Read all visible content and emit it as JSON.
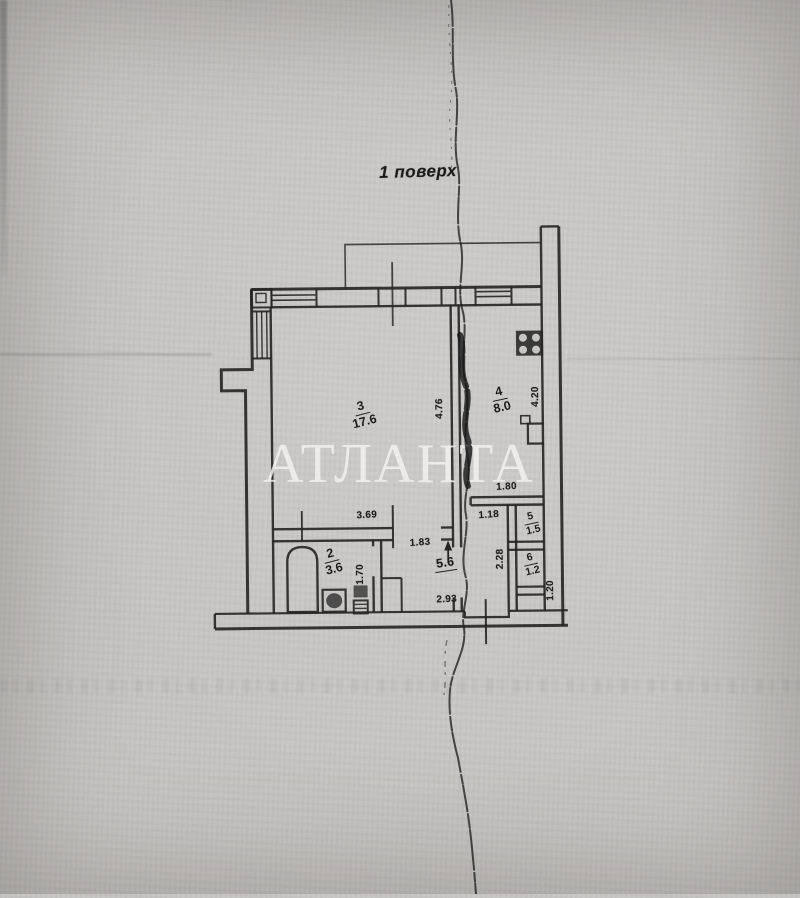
{
  "page": {
    "floor_title": "1 поверх",
    "watermark": "АТЛАНТА"
  },
  "rooms": [
    {
      "number": "3",
      "area": "17.6"
    },
    {
      "number": "4",
      "area": "8.0"
    },
    {
      "number": "2",
      "area": "3.6"
    },
    {
      "number": "5",
      "area": "1.5"
    },
    {
      "number": "6",
      "area": "1.2"
    }
  ],
  "hallway": {
    "area": "5.6"
  },
  "dims": {
    "living_width": "3.69",
    "living_height": "4.76",
    "kitchen_height": "4.20",
    "kitchen_pass": "1.80",
    "door_width": "1.83",
    "lobby_width": "1.18",
    "lobby_height": "2.28",
    "bath_depth": "1.70",
    "hall_width": "2.93",
    "shaft_height": "1.20"
  },
  "colors": {
    "paper": "#c7c5c3",
    "ink": "#242424",
    "watermark_color": "rgba(244,243,241,0.82)"
  }
}
